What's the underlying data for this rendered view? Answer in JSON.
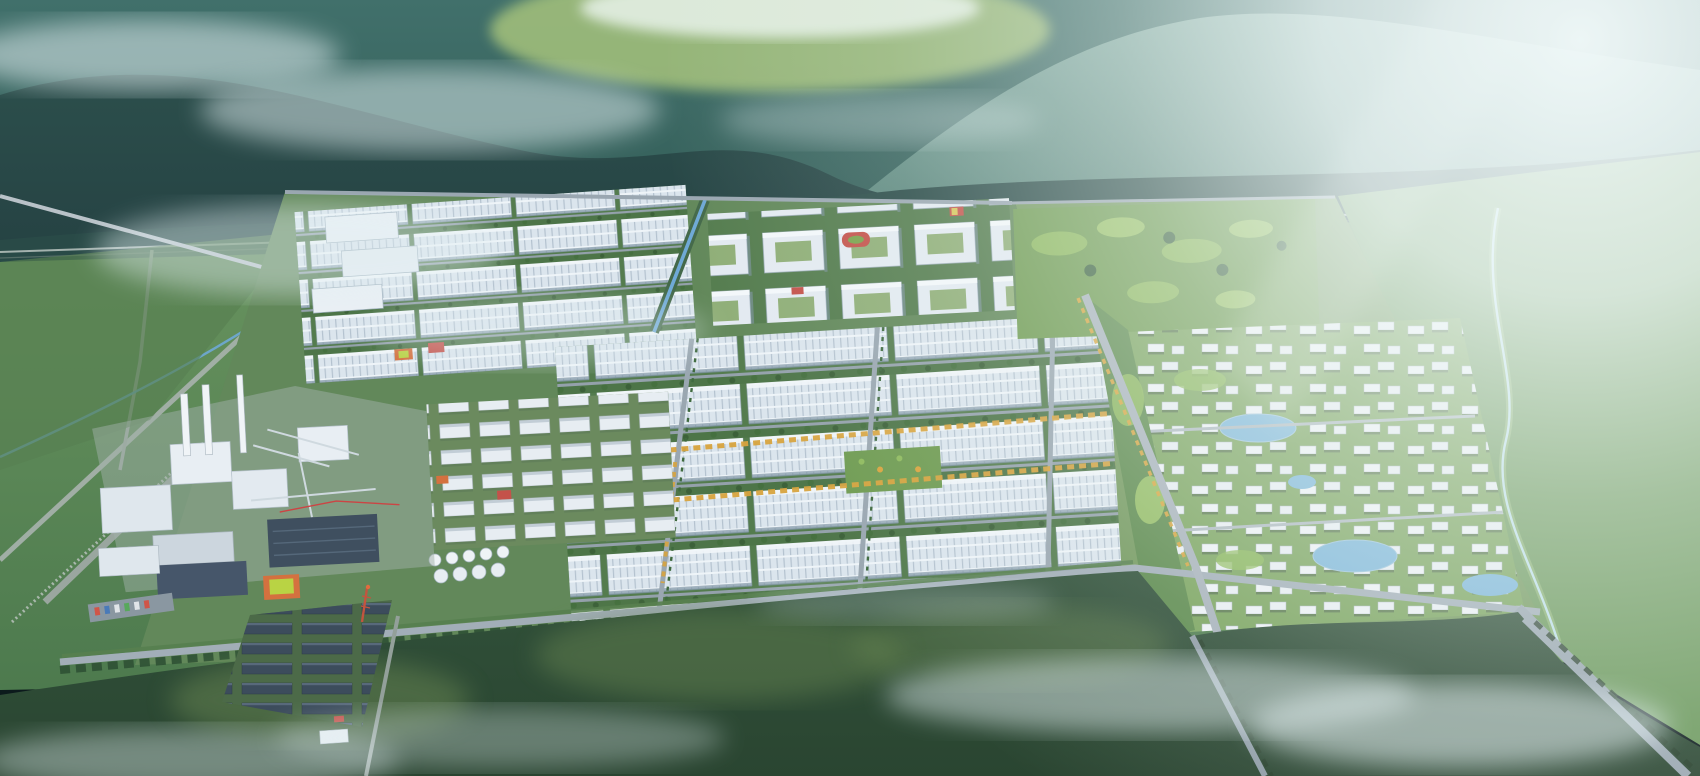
{
  "scene": {
    "type": "aerial-3d-architectural-rendering",
    "setting": "bird's-eye master-plan rendering of a large industrial park campus at the foot of forested mountains",
    "lighting": "hazy sun glare from the upper right, morning mist over mountains and foreground forest",
    "visible_text": [],
    "regions": [
      {
        "name": "mountain-range",
        "description": "layered teal-green forested ridges across the top with drifting mist"
      },
      {
        "name": "valley-clearing",
        "description": "pale green valley glimpse at top center between ridges"
      },
      {
        "name": "sun-glare",
        "description": "bright white haze washing out the upper-right corner"
      },
      {
        "name": "foothill-fields",
        "description": "green fields and a rail/road corridor at the mountain base"
      },
      {
        "name": "chemical-plant",
        "description": "process plant with stacks, pipe racks, tanks and dark-roof halls on the west side"
      },
      {
        "name": "warehouse-district-west",
        "description": "rows of white ridged-roof factory warehouses, upper left of campus"
      },
      {
        "name": "office-campus-north",
        "description": "courtyard office/dormitory blocks with red running track and sports courts"
      },
      {
        "name": "warehouse-district-central",
        "description": "grid of long white warehouses separated by tree-lined streets"
      },
      {
        "name": "autumn-avenues",
        "description": "streets flanked by yellow-orange autumn trees"
      },
      {
        "name": "canal",
        "description": "narrow blue canal between factory zones"
      },
      {
        "name": "hill-park",
        "description": "mounded green park northeast of the factories"
      },
      {
        "name": "residential-district",
        "description": "small white apartment buildings with ponds and winding paths, east side"
      },
      {
        "name": "river",
        "description": "stream winding through bright forest on the far right"
      },
      {
        "name": "construction-camp",
        "description": "cluster of dark-roof barracks with an orange derrick, bottom left"
      },
      {
        "name": "foreground-forest",
        "description": "dense dark-green forest with moss patches and low mist across the bottom"
      },
      {
        "name": "perimeter-roads",
        "description": "gray roads with green and yellow tree lines framing the campus"
      }
    ]
  },
  "palette": {
    "mountain_far": "#7fa79e",
    "mountain_mid": "#41706b",
    "mountain_near": "#2c4f4c",
    "valley_field": "#a5c27c",
    "haze_white": "#f2fafa",
    "plain_green": "#69945f",
    "field_green": "#587f52",
    "forest_dark": "#31513a",
    "forest_moss": "#6b8852",
    "roof_white": "#dbe5ed",
    "roof_shade": "#b4c2cf",
    "road_gray": "#a2aeb8",
    "tree_green": "#45703f",
    "tree_autumn": "#d8a43f",
    "canal_blue": "#6fa9d6",
    "pond_blue": "#7db6d9",
    "accent_red": "#c4524a",
    "accent_orange": "#d4713f",
    "court_green": "#b9d344",
    "dark_roof": "#3c4c5c",
    "mist_white": "#e3f0f3"
  }
}
